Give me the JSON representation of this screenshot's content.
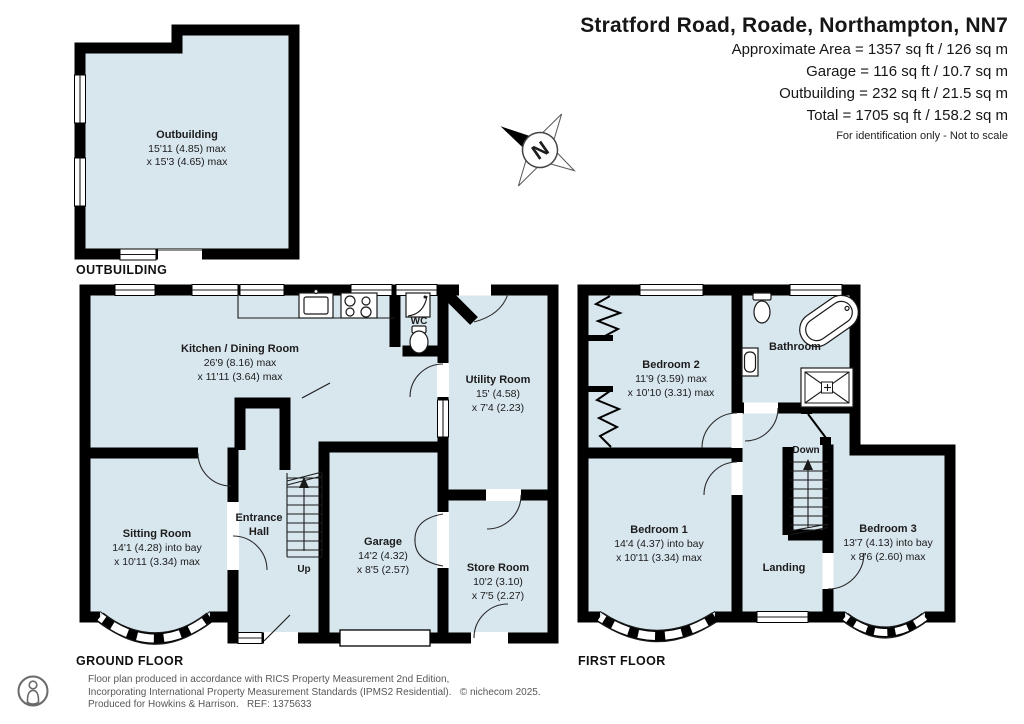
{
  "header": {
    "title": "Stratford Road, Roade, Northampton, NN7",
    "lines": [
      "Approximate Area = 1357 sq ft / 126 sq m",
      "Garage = 116 sq ft / 10.7 sq m",
      "Outbuilding = 232 sq ft / 21.5 sq m",
      "Total = 1705 sq ft / 158.2 sq m"
    ],
    "note": "For identification only - Not to scale"
  },
  "compass": {
    "north_label": "N"
  },
  "plans": {
    "outbuilding": {
      "floor_label": "OUTBUILDING",
      "room": {
        "name": "Outbuilding",
        "dim1": "15'11 (4.85) max",
        "dim2": "x 15'3 (4.65) max"
      }
    },
    "ground": {
      "floor_label": "GROUND FLOOR",
      "stairs_label": "Up",
      "rooms": [
        {
          "name": "Kitchen / Dining Room",
          "dim1": "26'9 (8.16) max",
          "dim2": "x 11'11 (3.64) max"
        },
        {
          "name": "Sitting Room",
          "dim1": "14'1 (4.28) into bay",
          "dim2": "x 10'11 (3.34) max"
        },
        {
          "name": "Entrance",
          "dim1": "Hall",
          "dim2": ""
        },
        {
          "name": "Garage",
          "dim1": "14'2 (4.32)",
          "dim2": "x 8'5 (2.57)"
        },
        {
          "name": "Utility Room",
          "dim1": "15' (4.58)",
          "dim2": "x 7'4 (2.23)"
        },
        {
          "name": "Store Room",
          "dim1": "10'2 (3.10)",
          "dim2": "x 7'5 (2.27)"
        },
        {
          "name": "WC",
          "dim1": "",
          "dim2": ""
        }
      ]
    },
    "first": {
      "floor_label": "FIRST FLOOR",
      "stairs_label": "Down",
      "rooms": [
        {
          "name": "Bedroom 2",
          "dim1": "11'9 (3.59) max",
          "dim2": "x 10'10 (3.31) max"
        },
        {
          "name": "Bathroom",
          "dim1": "",
          "dim2": ""
        },
        {
          "name": "Bedroom 1",
          "dim1": "14'4 (4.37) into bay",
          "dim2": "x 10'11 (3.34) max"
        },
        {
          "name": "Landing",
          "dim1": "",
          "dim2": ""
        },
        {
          "name": "Bedroom 3",
          "dim1": "13'7 (4.13) into bay",
          "dim2": "x 8'6 (2.60) max"
        }
      ]
    }
  },
  "footer": {
    "lines": [
      "Floor plan produced in accordance with RICS Property Measurement 2nd Edition,",
      "Incorporating International Property Measurement Standards (IPMS2 Residential).   © nichecom 2025.",
      "Produced for Howkins & Harrison.   REF: 1375633"
    ]
  },
  "colors": {
    "room_fill": "#d8e6ee",
    "wall": "#000000"
  }
}
